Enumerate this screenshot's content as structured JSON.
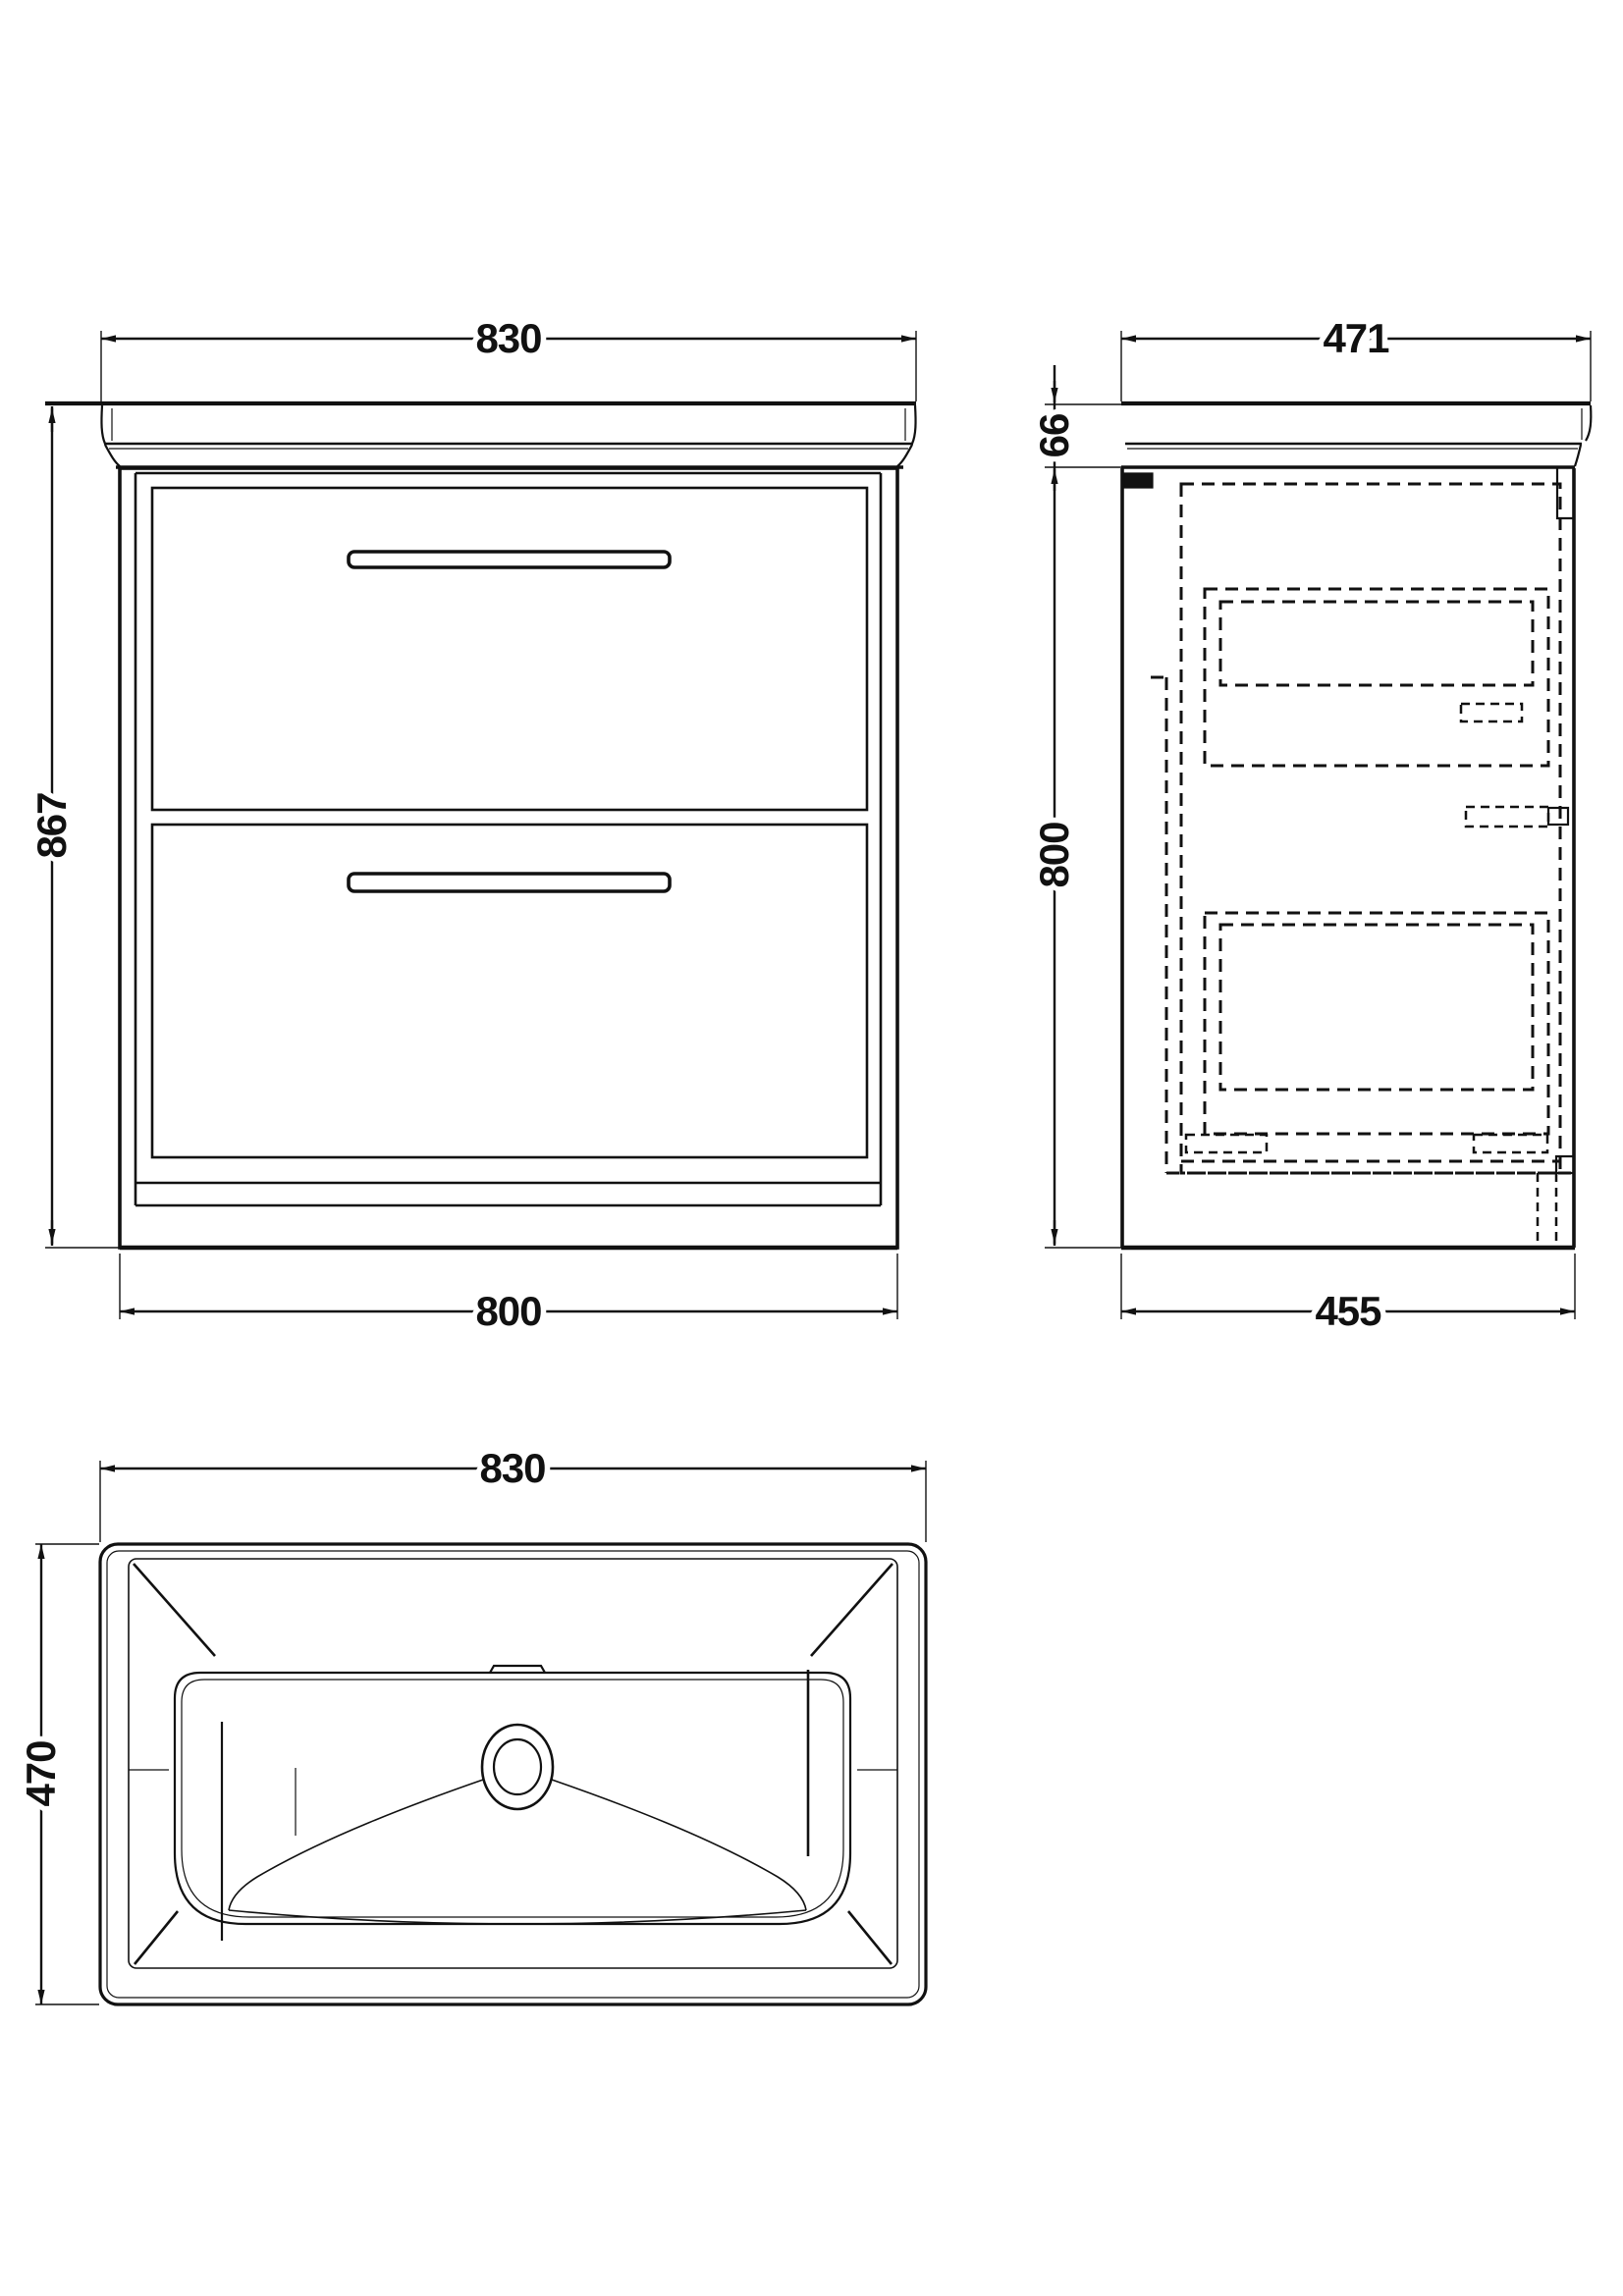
{
  "document": {
    "kind": "technical-drawing",
    "subject": "floor-standing vanity unit with 2 drawers and basin",
    "background_color": "#ffffff",
    "line_color": "#111111"
  },
  "views": {
    "front": {
      "label": "front elevation",
      "dimensions": {
        "worktop_width": "830",
        "overall_height": "867",
        "cabinet_width": "800"
      }
    },
    "side": {
      "label": "side elevation",
      "dimensions": {
        "worktop_depth": "471",
        "worktop_height": "66",
        "cabinet_height": "800",
        "cabinet_depth": "455"
      }
    },
    "plan": {
      "label": "basin plan",
      "dimensions": {
        "basin_width": "830",
        "basin_depth": "470"
      }
    }
  }
}
